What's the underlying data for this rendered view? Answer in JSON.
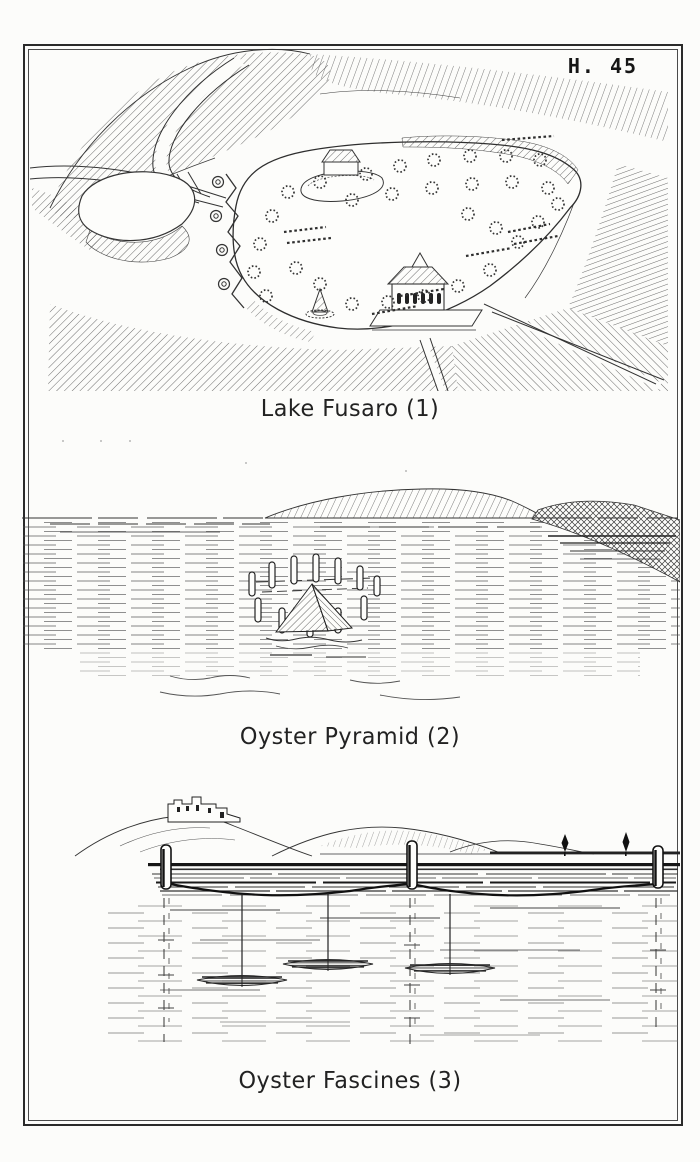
{
  "plate": {
    "number": "H. 45"
  },
  "figures": [
    {
      "caption": "Lake Fusaro (1)"
    },
    {
      "caption": "Oyster Pyramid (2)"
    },
    {
      "caption": "Oyster Fascines (3)"
    }
  ],
  "colors": {
    "ink": "#1c1c1c",
    "paper": "#fcfcfa",
    "frame": "#2a2a2a"
  }
}
